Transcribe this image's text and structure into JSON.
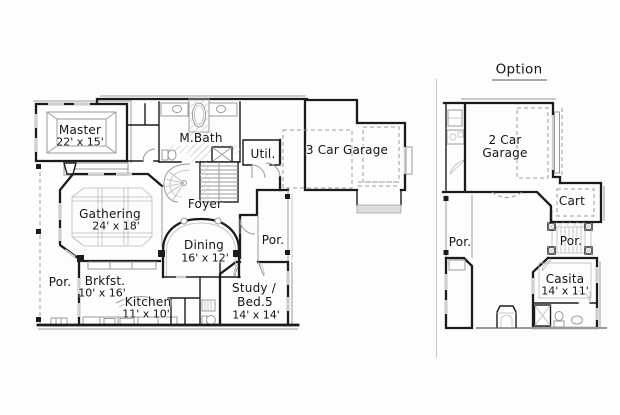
{
  "colors": {
    "background": "#fdfdfd",
    "wall": "#1b1b1b",
    "detail": "#9a9a9a",
    "light": "#cfcfcf",
    "fill": "#dcdcdc",
    "text": "#141414"
  },
  "plans": {
    "main": {
      "rooms": {
        "master": {
          "name": "Master",
          "dims": "22' x 15'"
        },
        "mbath": {
          "name": "M.Bath"
        },
        "util": {
          "name": "Util."
        },
        "garage": {
          "name": "3 Car Garage"
        },
        "foyer": {
          "name": "Foyer"
        },
        "gathering": {
          "name": "Gathering",
          "dims": "24' x 18'"
        },
        "dining": {
          "name": "Dining",
          "dims": "16' x 12'"
        },
        "porch_rear": {
          "name": "Por."
        },
        "porch_side": {
          "name": "Por."
        },
        "brkfst": {
          "name": "Brkfst.",
          "dims": "10' x 16'"
        },
        "kitchen": {
          "name": "Kitchen",
          "dims": "11' x 10'"
        },
        "study": {
          "name_line1": "Study /",
          "name_line2": "Bed.5",
          "dims": "14' x 14'"
        }
      }
    },
    "option": {
      "title": "Option",
      "rooms": {
        "garage": {
          "name_line1": "2 Car",
          "name_line2": "Garage"
        },
        "cart": {
          "name": "Cart"
        },
        "porch_left": {
          "name": "Por."
        },
        "porch_right": {
          "name": "Por."
        },
        "casita": {
          "name": "Casita",
          "dims": "14' x 11'"
        }
      }
    }
  }
}
